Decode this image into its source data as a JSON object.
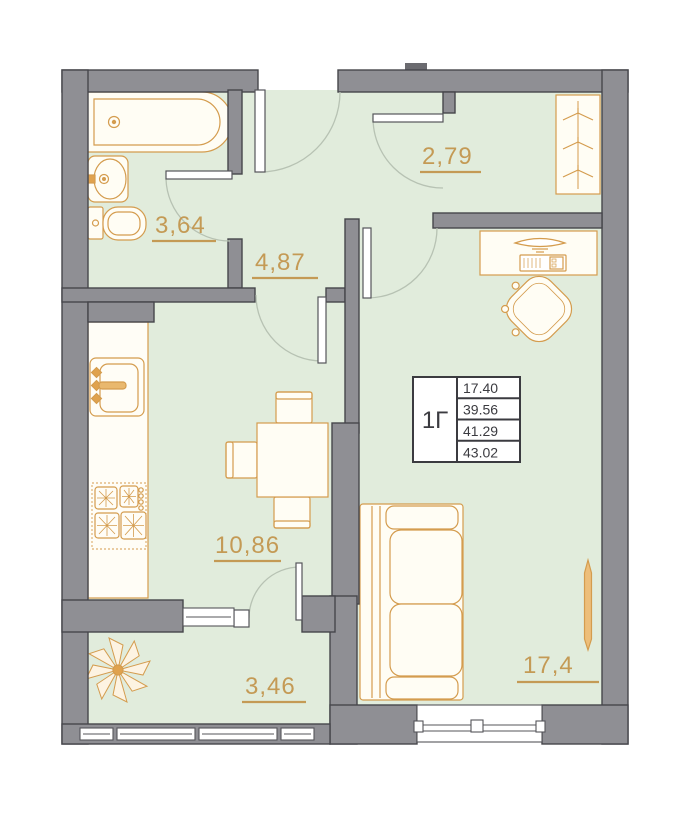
{
  "plan": {
    "title": "apartment-floor-plan",
    "unit": {
      "type_label": "1Г",
      "info_table_rows": [
        "17.40",
        "39.56",
        "41.29",
        "43.02"
      ]
    },
    "rooms": {
      "bathroom": {
        "area": "3,64"
      },
      "hallway": {
        "area": "4,87"
      },
      "wardrobe_room": {
        "area": "2,79"
      },
      "kitchen_dining": {
        "area": "10,86"
      },
      "balcony": {
        "area": "3,46"
      },
      "living_room": {
        "area": "17,4"
      }
    },
    "fixtures": [
      "bathtub",
      "bathroom-sink",
      "toilet",
      "kitchen-counter",
      "kitchen-sink",
      "stove",
      "dining-table",
      "dining-chairs",
      "plant",
      "sofa",
      "desk",
      "office-chair",
      "wardrobe",
      "radiator"
    ],
    "colors": {
      "wall_fill": "#8f8f94",
      "wall_edge": "#46464b",
      "floor": "#e1ecdc",
      "fixture_outline": "#d49c4e",
      "fixture_fill": "#fffdf4",
      "label_gold": "#c49a55",
      "table_text": "#3b3b40",
      "door_arc": "#b7c2b3"
    }
  }
}
